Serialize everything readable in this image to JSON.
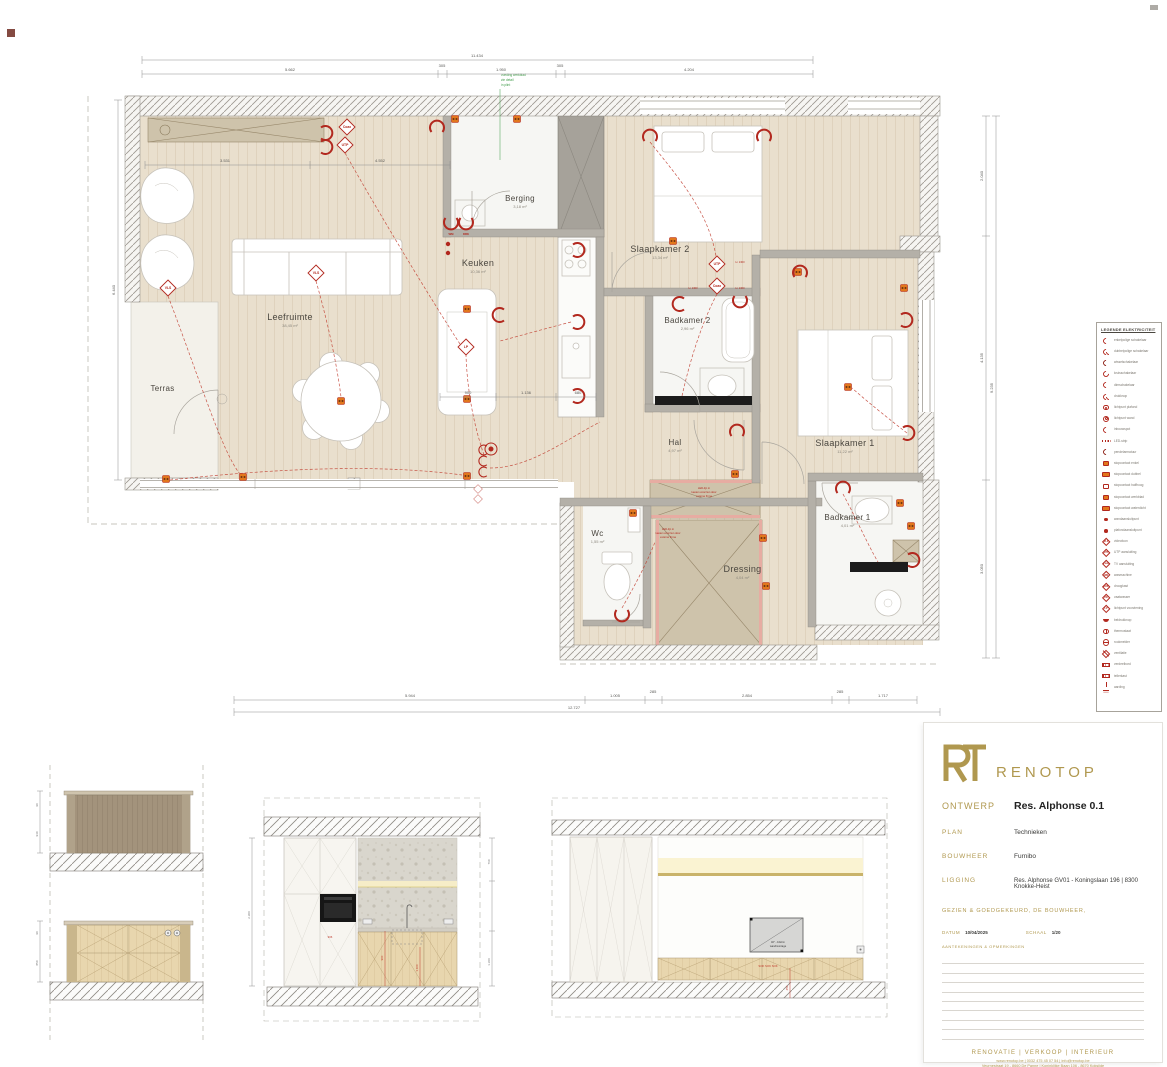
{
  "plan": {
    "rooms": [
      {
        "name": "Leefruimte",
        "area": "38,45 m²"
      },
      {
        "name": "Keuken",
        "area": "10,36 m²"
      },
      {
        "name": "Berging",
        "area": "3,18 m²"
      },
      {
        "name": "Slaapkamer 2",
        "area": "13,34 m²"
      },
      {
        "name": "Badkamer 2",
        "area": "2,96 m²"
      },
      {
        "name": "Hal",
        "area": "4,97 m²"
      },
      {
        "name": "Slaapkamer 1",
        "area": "11,22 m²"
      },
      {
        "name": "Badkamer 1",
        "area": "4,01 m²"
      },
      {
        "name": "Wc",
        "area": "1,55 m²"
      },
      {
        "name": "Dressing",
        "area": "4,04 m²"
      },
      {
        "name": "Terras",
        "area": ""
      }
    ],
    "symbols": {
      "coax": "Coax",
      "utp": "UTP",
      "vls": "VLS",
      "lp": "LP",
      "wm": "WM",
      "drk": "DRK",
      "h1300": "H. 1300"
    },
    "notes": {
      "green": [
        "voeding werkblad",
        "zie detail",
        "in plint"
      ],
      "led_a": [
        "LED-lijn in",
        "kasten voorzien door",
        "externe firma"
      ],
      "led_b": [
        "LED-lijn in",
        "kasten voorzien door",
        "externe firma"
      ]
    },
    "dims": {
      "top_total": "11.434",
      "top_segments": [
        "5.662",
        "305",
        "1.950",
        "305",
        "4.204"
      ],
      "inner_segments": [
        "3.531",
        "4.552"
      ],
      "inner2": [
        "900",
        "1.136",
        "680"
      ],
      "bottom_segments": [
        "5.944",
        "1.005",
        "285",
        "2.854",
        "285",
        "1.717"
      ],
      "bottom_total": "12.727",
      "left_total": "6.440",
      "right_segments": [
        "2.040",
        "4.135",
        "3.050"
      ],
      "right_total": "9.235"
    }
  },
  "legend": {
    "title": "LEGENDE ELEKTRICITEIT",
    "items": [
      {
        "type": "arc",
        "label": "enkelpolige schakelaar"
      },
      {
        "type": "arc2",
        "label": "dubbelpolige schakelaar"
      },
      {
        "type": "arc3",
        "label": "wisselschakelaar"
      },
      {
        "type": "dim",
        "label": "kruisschakelaar"
      },
      {
        "type": "arc",
        "label": "dimschakelaar"
      },
      {
        "type": "arc2",
        "label": "drukknop"
      },
      {
        "type": "spot",
        "label": "lichtpunt plafond"
      },
      {
        "type": "spot2",
        "label": "lichtpunt wand"
      },
      {
        "type": "arc",
        "label": "inbouwspot"
      },
      {
        "type": "led",
        "label": "LED-strip"
      },
      {
        "type": "arc3",
        "label": "pendelarmatuur"
      },
      {
        "type": "socket",
        "label": "stopcontact enkel"
      },
      {
        "type": "socket2",
        "label": "stopcontact dubbel"
      },
      {
        "type": "socketh",
        "label": "stopcontact halfhoog"
      },
      {
        "type": "socket",
        "label": "stopcontact werkblad"
      },
      {
        "type": "socket2",
        "label": "stopcontact waterdicht"
      },
      {
        "type": "dot",
        "label": "wandaansluitpunt"
      },
      {
        "type": "dot",
        "label": "plafondaansluitpunt"
      },
      {
        "type": "diamond",
        "code": "VLS",
        "label": "videofoon"
      },
      {
        "type": "diamond",
        "code": "UTP",
        "label": "UTP aansluiting"
      },
      {
        "type": "diamond",
        "code": "Coax",
        "label": "TV aansluiting"
      },
      {
        "type": "diamond",
        "code": "WM",
        "label": "wasmachine"
      },
      {
        "type": "diamond",
        "code": "DRK",
        "label": "droogkast"
      },
      {
        "type": "diamond",
        "code": "VW",
        "label": "vaatwasser"
      },
      {
        "type": "diamond",
        "code": "LP",
        "label": "lichtpunt voorziening"
      },
      {
        "type": "bell",
        "label": "beldrukknop"
      },
      {
        "type": "therm",
        "label": "thermostaat"
      },
      {
        "type": "smoke",
        "label": "rookmelder"
      },
      {
        "type": "vent",
        "label": "ventilatie"
      },
      {
        "type": "board",
        "label": "verdeelbord"
      },
      {
        "type": "board",
        "label": "tellerkast"
      },
      {
        "type": "ground",
        "label": "aarding"
      }
    ]
  },
  "elevations": {
    "island": {
      "d1": "90",
      "d2": "940",
      "d3": "90",
      "d4": "850"
    },
    "kitchen": {
      "left": "2.300",
      "r1": "760",
      "r2": "1.360",
      "red1": "900",
      "red2": "1.100",
      "red0": "906"
    },
    "tv": {
      "label1": "40\" - 102cm",
      "label2": "wandmontage",
      "sok": "SOK  SOK  SOK",
      "red": "450"
    }
  },
  "title_block": {
    "brand": "RENOTOP",
    "rows": [
      {
        "label": "ONTWERP",
        "value": "Res. Alphonse 0.1"
      },
      {
        "label": "PLAN",
        "value": "Technieken"
      },
      {
        "label": "BOUWHEER",
        "value": "Furnibo"
      },
      {
        "label": "LIGGING",
        "value": "Res. Alphonse GV01 - Koningslaan 196 | 8300 Knokke-Heist"
      }
    ],
    "approval": "GEZIEN & GOEDGEKEURD, DE BOUWHEER,",
    "datum_label": "DATUM",
    "datum": "10/04/2025",
    "schaal_label": "SCHAAL",
    "schaal": "1/20",
    "notes_label": "AANTEKENINGEN & OPMERKINGEN",
    "footer": {
      "services": "RENOVATIE   |   VERKOOP   |   INTERIEUR",
      "contact": "www.renotop.be   |   0032 475 45 07 54   |   info@renotop.be",
      "addresses": "Veurnestraat 19 - 8660 De Panne   |   Koninklijke Baan 106 - 8670 Koksijde",
      "brand": "RENOTOP"
    }
  }
}
